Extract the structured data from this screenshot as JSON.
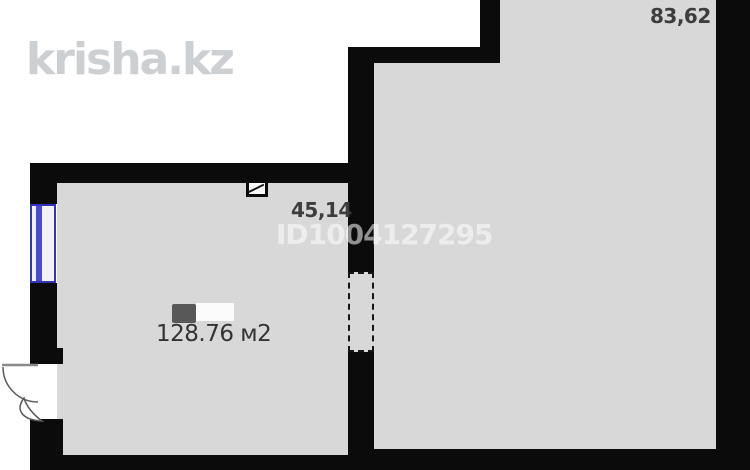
{
  "branding": {
    "logo": "krisha.kz"
  },
  "watermark": {
    "id": "ID1004127295"
  },
  "labels": {
    "room_right_area": "83,62",
    "room_left_width": "45,14",
    "total_area": "128.76 м2"
  },
  "colors": {
    "wall": "#0b0b0b",
    "floor": "#d8d8d8",
    "outside": "#ffffff",
    "window_frame": "#3232bb",
    "logo_text": "#cdd0d3",
    "label_text": "#3d3d3d"
  }
}
